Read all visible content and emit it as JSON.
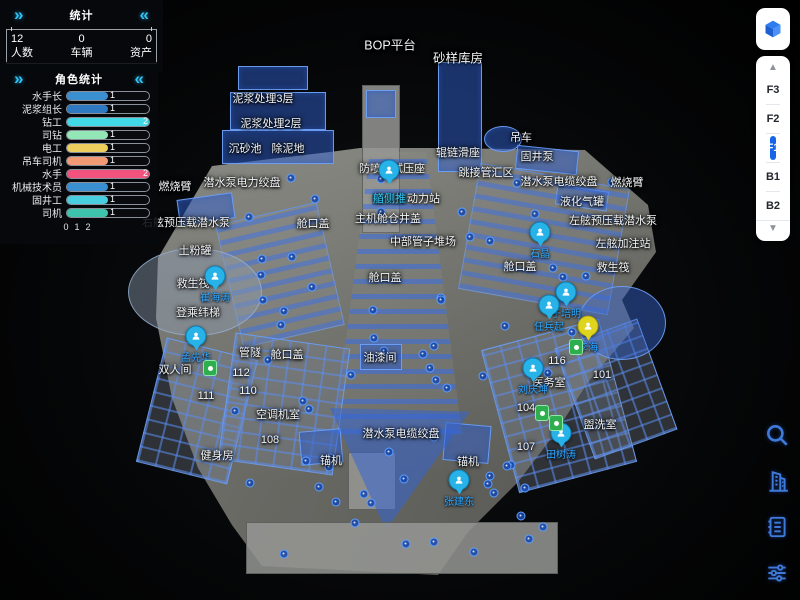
{
  "stats_panel": {
    "title": "统计",
    "collapse_left": "»",
    "collapse_right": "«",
    "items": [
      {
        "value": "12",
        "label": "人数"
      },
      {
        "value": "0",
        "label": "车辆"
      },
      {
        "value": "0",
        "label": "资产"
      }
    ]
  },
  "role_panel": {
    "title": "角色统计",
    "collapse_left": "»",
    "collapse_right": "«",
    "max": 2,
    "axis": [
      "0",
      "1",
      "2"
    ],
    "bars": [
      {
        "label": "水手长",
        "value": 1,
        "color": "#3a8fd0"
      },
      {
        "label": "泥浆组长",
        "value": 1,
        "color": "#2e79c0"
      },
      {
        "label": "钻工",
        "value": 2,
        "color": "#41d8e8"
      },
      {
        "label": "司钻",
        "value": 1,
        "color": "#93e6b5"
      },
      {
        "label": "电工",
        "value": 1,
        "color": "#eecf5e"
      },
      {
        "label": "吊车司机",
        "value": 1,
        "color": "#f29a74"
      },
      {
        "label": "水手",
        "value": 2,
        "color": "#f2537e"
      },
      {
        "label": "机械技术员",
        "value": 1,
        "color": "#3a8fd0"
      },
      {
        "label": "固井工",
        "value": 1,
        "color": "#48cede"
      },
      {
        "label": "司机",
        "value": 1,
        "color": "#3ec3ac"
      }
    ]
  },
  "floor_selector": {
    "cube_icon": "cube-icon",
    "up_arrow": "▲",
    "down_arrow": "▼",
    "floors": [
      "F3",
      "F2",
      "F1",
      "B1",
      "B2"
    ],
    "active": "F1",
    "active_color": "#1766e8"
  },
  "toolbar": {
    "icons": [
      {
        "name": "search-icon"
      },
      {
        "name": "building-icon"
      },
      {
        "name": "list-icon"
      },
      {
        "name": "filter-sliders-icon"
      }
    ],
    "icon_color": "#3f7ad9"
  },
  "scene": {
    "accent_blue": "#2da6ff",
    "labels": [
      {
        "text": "BOP平台",
        "x": 390,
        "y": 44,
        "big": true
      },
      {
        "text": "砂样库房",
        "x": 458,
        "y": 57,
        "big": true
      },
      {
        "text": "泥浆处理3层",
        "x": 263,
        "y": 98
      },
      {
        "text": "泥浆处理2层",
        "x": 271,
        "y": 123
      },
      {
        "text": "沉砂池",
        "x": 245,
        "y": 148
      },
      {
        "text": "除泥地",
        "x": 288,
        "y": 148
      },
      {
        "text": "吊车",
        "x": 521,
        "y": 137
      },
      {
        "text": "辊链滑座",
        "x": 458,
        "y": 152
      },
      {
        "text": "固井泵",
        "x": 537,
        "y": 156
      },
      {
        "text": "跳接管汇区",
        "x": 486,
        "y": 172
      },
      {
        "text": "潜水泵电缆绞盘",
        "x": 559,
        "y": 181
      },
      {
        "text": "燃烧臂",
        "x": 627,
        "y": 182
      },
      {
        "text": "潜水泵电力绞盘",
        "x": 242,
        "y": 182
      },
      {
        "text": "燃烧臂",
        "x": 175,
        "y": 186
      },
      {
        "text": "液化气罐",
        "x": 582,
        "y": 201
      },
      {
        "text": "防喷器试压座",
        "x": 392,
        "y": 168
      },
      {
        "text": "右舷预压载潜水泵",
        "x": 186,
        "y": 222
      },
      {
        "text": "左舷预压载潜水泵",
        "x": 613,
        "y": 220
      },
      {
        "text": "主机舱仓井盖",
        "x": 388,
        "y": 218
      },
      {
        "text": "舱口盖",
        "x": 313,
        "y": 223
      },
      {
        "text": "左舷加注站",
        "x": 623,
        "y": 243
      },
      {
        "text": "中部管子堆场",
        "x": 423,
        "y": 241
      },
      {
        "text": "土粉罐",
        "x": 195,
        "y": 250
      },
      {
        "text": "救生筏",
        "x": 193,
        "y": 283
      },
      {
        "text": "救生筏",
        "x": 613,
        "y": 267
      },
      {
        "text": "舱口盖",
        "x": 520,
        "y": 266
      },
      {
        "text": "舱口盖",
        "x": 385,
        "y": 277
      },
      {
        "text": "登乘纬梯",
        "x": 198,
        "y": 312
      },
      {
        "text": "双人间",
        "x": 175,
        "y": 369
      },
      {
        "text": "管隧",
        "x": 250,
        "y": 352
      },
      {
        "text": "舱口盖",
        "x": 287,
        "y": 354
      },
      {
        "text": "油漆间",
        "x": 380,
        "y": 357
      },
      {
        "text": "112",
        "x": 241,
        "y": 373
      },
      {
        "text": "110",
        "x": 248,
        "y": 391
      },
      {
        "text": "111",
        "x": 206,
        "y": 396
      },
      {
        "text": "空调机室",
        "x": 278,
        "y": 414
      },
      {
        "text": "108",
        "x": 270,
        "y": 440
      },
      {
        "text": "健身房",
        "x": 217,
        "y": 455
      },
      {
        "text": "潜水泵电缆绞盘",
        "x": 401,
        "y": 433
      },
      {
        "text": "锚机",
        "x": 331,
        "y": 460
      },
      {
        "text": "锚机",
        "x": 468,
        "y": 461
      },
      {
        "text": "107",
        "x": 526,
        "y": 447
      },
      {
        "text": "104",
        "x": 526,
        "y": 408
      },
      {
        "text": "116",
        "x": 557,
        "y": 361
      },
      {
        "text": "医务室",
        "x": 549,
        "y": 382
      },
      {
        "text": "101",
        "x": 602,
        "y": 375
      },
      {
        "text": "盥洗室",
        "x": 600,
        "y": 424
      }
    ],
    "rich_label": {
      "x": 406,
      "y": 198,
      "parts": [
        {
          "text": "艏侧推",
          "highlight": true
        },
        {
          "text": "动力站",
          "highlight": false
        }
      ]
    },
    "persons": [
      {
        "name": "石晶",
        "x": 540,
        "y": 232,
        "color": "blue"
      },
      {
        "name": "崔海涛",
        "x": 215,
        "y": 276,
        "color": "blue"
      },
      {
        "name": "孟先华",
        "x": 196,
        "y": 336,
        "color": "blue"
      },
      {
        "name": "",
        "x": 389,
        "y": 170,
        "color": "blue"
      },
      {
        "name": "于培明",
        "x": 566,
        "y": 292,
        "color": "blue"
      },
      {
        "name": "任兵起",
        "x": 549,
        "y": 305,
        "color": "blue"
      },
      {
        "name": "李海",
        "x": 588,
        "y": 326,
        "color": "yellow"
      },
      {
        "name": "刘庆坤",
        "x": 533,
        "y": 368,
        "color": "blue"
      },
      {
        "name": "田树涛",
        "x": 561,
        "y": 433,
        "color": "blue"
      },
      {
        "name": "张建东",
        "x": 459,
        "y": 480,
        "color": "blue"
      }
    ],
    "devices": [
      {
        "x": 210,
        "y": 368
      },
      {
        "x": 576,
        "y": 347
      },
      {
        "x": 542,
        "y": 413
      },
      {
        "x": 556,
        "y": 423
      }
    ]
  }
}
